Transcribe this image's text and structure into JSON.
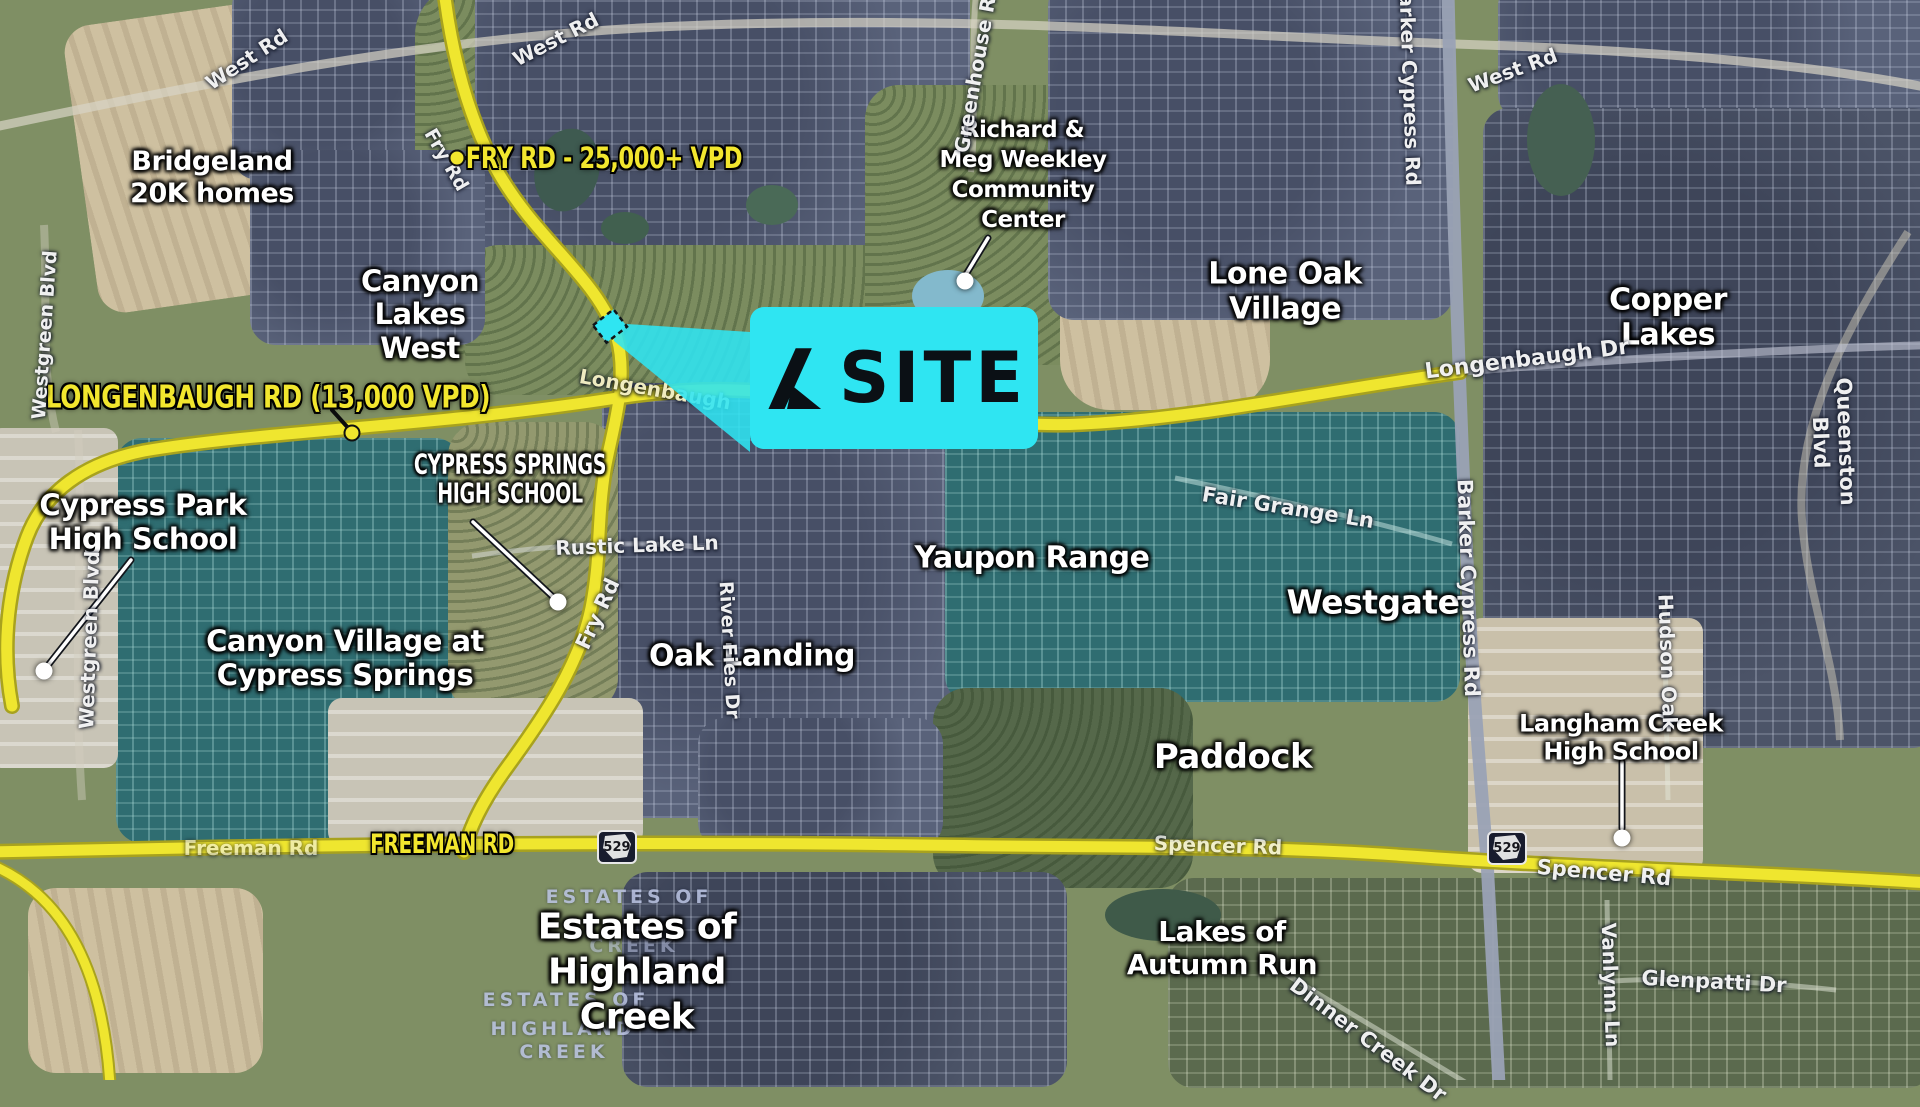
{
  "colors": {
    "site_cyan": "#2fe5f2",
    "road_yellow": "#f2e62e",
    "teal_overlay": "#2f6d71",
    "label_white": "#ffffff"
  },
  "site_callout": {
    "label": "SITE"
  },
  "road_callouts": [
    {
      "id": "fry-rd",
      "text": "FRY RD - 25,000+ VPD"
    },
    {
      "id": "longenbaugh-rd",
      "text": "LONGENBAUGH RD (13,000 VPD)"
    },
    {
      "id": "freeman-rd",
      "text": "FREEMAN RD"
    }
  ],
  "poi_callouts": [
    {
      "id": "weekley-community-center",
      "text": "Richard &\nMeg Weekley\nCommunity\nCenter"
    },
    {
      "id": "cypress-park-hs",
      "text": "Cypress Park\nHigh School"
    },
    {
      "id": "cypress-springs-hs",
      "text": "CYPRESS SPRINGS\nHIGH SCHOOL"
    },
    {
      "id": "langham-creek-hs",
      "text": "Langham Creek\nHigh School"
    }
  ],
  "area_labels": [
    {
      "id": "bridgeland",
      "text": "Bridgeland\n20K homes"
    },
    {
      "id": "canyon-lakes-west",
      "text": "Canyon\nLakes\nWest"
    },
    {
      "id": "lone-oak-village",
      "text": "Lone Oak\nVillage"
    },
    {
      "id": "copper-lakes",
      "text": "Copper\nLakes"
    },
    {
      "id": "yaupon-range",
      "text": "Yaupon Range"
    },
    {
      "id": "westgate",
      "text": "Westgate"
    },
    {
      "id": "oak-landing",
      "text": "Oak Landing"
    },
    {
      "id": "paddock",
      "text": "Paddock"
    },
    {
      "id": "canyon-village",
      "text": "Canyon Village at\nCypress Springs"
    },
    {
      "id": "estates-highland-creek",
      "text": "Estates of\nHighland\nCreek"
    },
    {
      "id": "lakes-autumn-run",
      "text": "Lakes of\nAutumn Run"
    }
  ],
  "street_labels": [
    {
      "id": "west-rd-nw",
      "text": "West Rd"
    },
    {
      "id": "west-rd-n",
      "text": "West Rd"
    },
    {
      "id": "west-rd-ne",
      "text": "West Rd"
    },
    {
      "id": "fry-rd-top",
      "text": "Fry Rd"
    },
    {
      "id": "fry-rd-mid",
      "text": "Fry Rd"
    },
    {
      "id": "westgreen-blvd-upper",
      "text": "Westgreen Blvd"
    },
    {
      "id": "westgreen-blvd-lower",
      "text": "Westgreen Blvd"
    },
    {
      "id": "barker-cypress-top",
      "text": "Barker Cypress Rd"
    },
    {
      "id": "barker-cypress-mid",
      "text": "Barker Cypress Rd"
    },
    {
      "id": "greenhouse-rd",
      "text": "Greenhouse Rd"
    },
    {
      "id": "longenbaugh-dr",
      "text": "Longenbaugh Dr"
    },
    {
      "id": "longenbaugh-w",
      "text": "Longenbaugh"
    },
    {
      "id": "queenston-blvd",
      "text": "Queenston Blvd"
    },
    {
      "id": "fair-grange-ln",
      "text": "Fair Grange Ln"
    },
    {
      "id": "rustic-lake-ln",
      "text": "Rustic Lake Ln"
    },
    {
      "id": "river-fies-dr",
      "text": "River Fies Dr"
    },
    {
      "id": "hudson-oak",
      "text": "Hudson Oak"
    },
    {
      "id": "vanlynn-ln",
      "text": "Vanlynn Ln"
    },
    {
      "id": "glenpatti-dr",
      "text": "Glenpatti Dr"
    },
    {
      "id": "dinner-creek-dr",
      "text": "Dinner Creek Dr"
    },
    {
      "id": "spencer-rd-w",
      "text": "Spencer Rd"
    },
    {
      "id": "spencer-rd-e",
      "text": "Spencer Rd"
    },
    {
      "id": "freeman-rd-map",
      "text": "Freeman Rd"
    }
  ],
  "map_sublabels": [
    {
      "text": "ESTATES OF"
    },
    {
      "text": "CREEK"
    },
    {
      "text": "ESTATES OF"
    },
    {
      "text": "HIGHLAND"
    },
    {
      "text": "CREEK"
    }
  ],
  "highway_shields": [
    {
      "number": "529"
    },
    {
      "number": "529"
    }
  ]
}
